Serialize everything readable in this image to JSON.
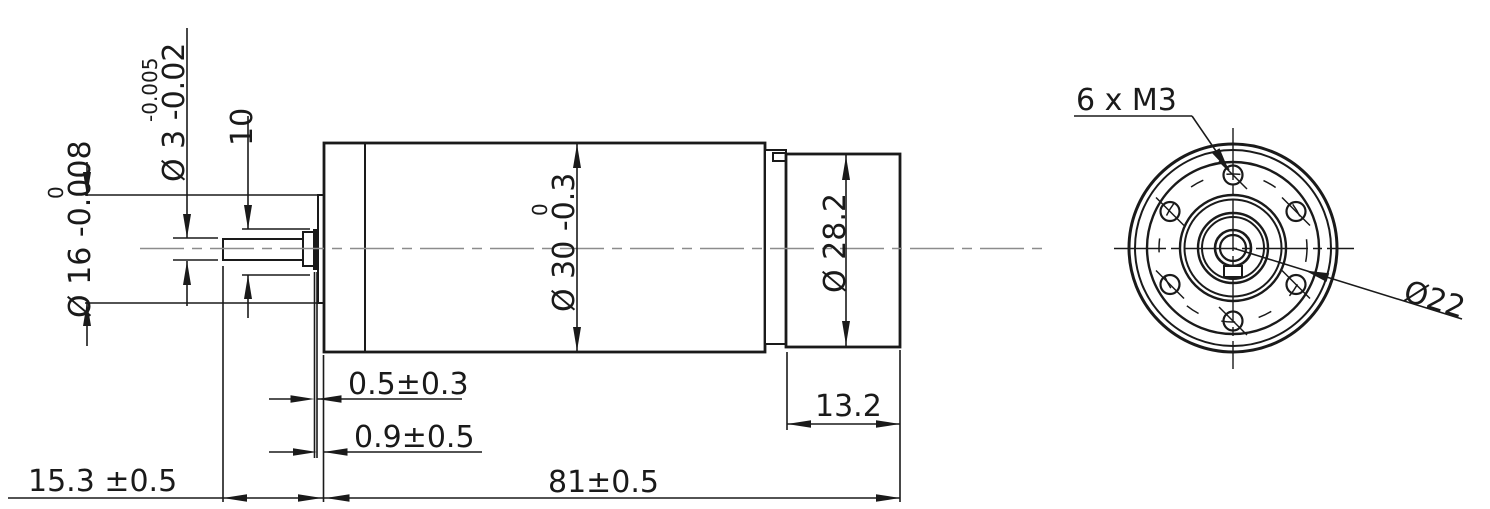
{
  "drawing_meta": {
    "kind": "gearmotor-dimension-drawing",
    "ink_color": "#1a1a1a",
    "centerline_color": "#8c8c8c",
    "background": "#ffffff"
  },
  "side_view": {
    "dims": {
      "shaft_dia": {
        "main": "Ø 3 -0.02",
        "upper": "-0.005"
      },
      "pilot_dia": {
        "main": "Ø 16 -0.008",
        "upper": "0"
      },
      "shaft_len": "10",
      "body_dia": {
        "main": "Ø 30 -0.3",
        "upper": "0"
      },
      "cap_dia": "Ø 28.2",
      "washer_gap": "0.5±0.3",
      "shoulder_gap": "0.9±0.5",
      "cap_len": "13.2",
      "shaft_ext": "15.3 ±0.5",
      "body_len": "81±0.5"
    }
  },
  "end_view": {
    "holes_label": "6 x  M3",
    "bolt_circle_label": "Ø22"
  }
}
